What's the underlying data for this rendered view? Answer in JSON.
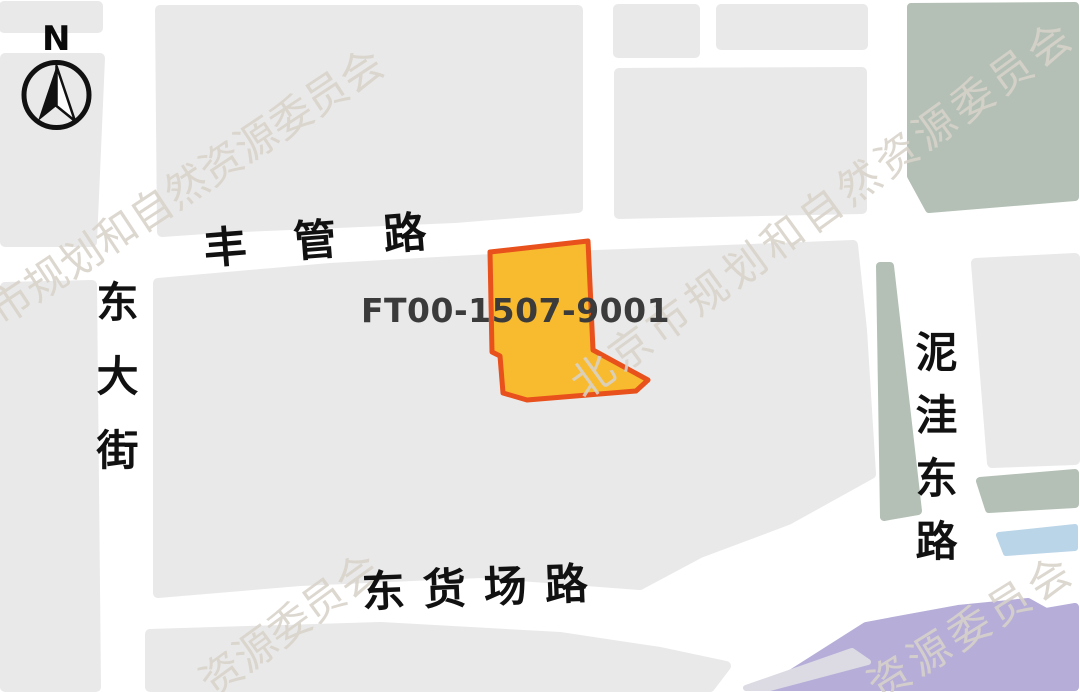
{
  "map": {
    "compass": {
      "label": "N"
    },
    "parcel": {
      "id": "FT00-1507-9001",
      "fill": "#f8ba2e",
      "outline": "#e8501c"
    },
    "roads": {
      "north": "丰管路",
      "west": "东大街",
      "east": "泥洼东路",
      "south": "东货场路"
    },
    "watermark": {
      "full": "北京市规划和自然资源委员会",
      "fragment": "资源委员会"
    },
    "colors": {
      "block": "#e9e9e9",
      "road": "#ffffff",
      "green": "#b4c0b6",
      "water": "#bad5e8",
      "purple": "#b6aed8",
      "purple_strip": "#dcdbe4",
      "ink": "#111111"
    }
  }
}
